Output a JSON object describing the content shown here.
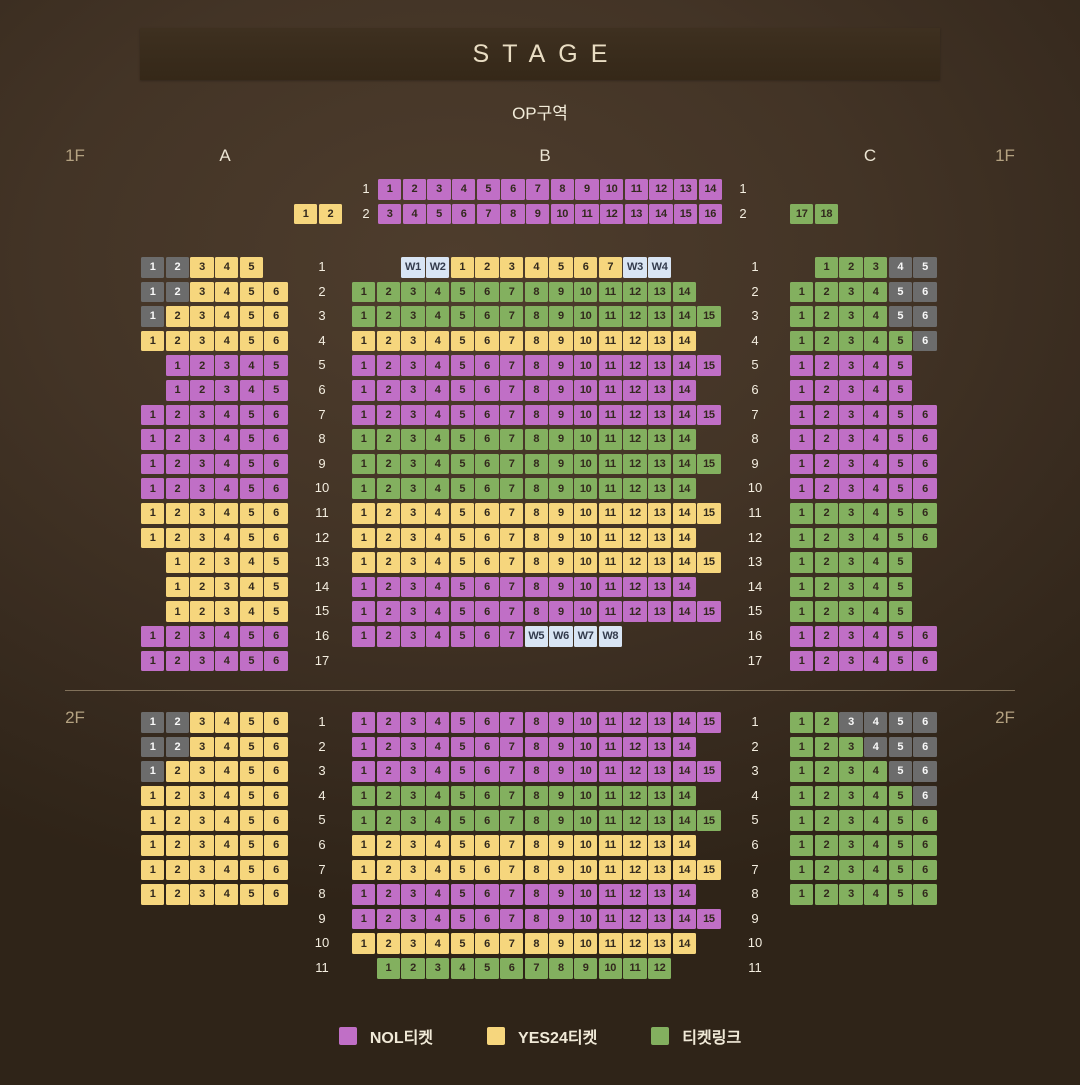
{
  "stage": {
    "label": "STAGE"
  },
  "op_label": "OP구역",
  "section_labels": {
    "a": "A",
    "b": "B",
    "c": "C"
  },
  "colors": {
    "nol": "#c06fc6",
    "yes24": "#f6d67d",
    "ticketlink": "#83b05f",
    "unavailable": "#6c6c6c",
    "wheelchair": "#d9e5f4",
    "seat_text_dark": "#32291d",
    "seat_text_light": "#f8f8f8",
    "wheelchair_text": "#333b4d"
  },
  "legend": [
    {
      "code": "p",
      "label": "NOL티켓"
    },
    {
      "code": "y",
      "label": "YES24티켓"
    },
    {
      "code": "g",
      "label": "티켓링크"
    }
  ],
  "op": {
    "left_row": {
      "label": "2",
      "start": 1,
      "seats": "1:y,2:y"
    },
    "b_rows": [
      {
        "label": "1",
        "start": 1,
        "seats": "1-14:p"
      },
      {
        "label": "2",
        "start": 1,
        "seats": "3-16:p"
      }
    ],
    "right_row": {
      "label": "2",
      "start": 1,
      "seats": "17:g,18:g"
    },
    "left_labels": [
      "1",
      "2"
    ],
    "right_labels": [
      "1",
      "2"
    ]
  },
  "floor1": {
    "name": "1F",
    "row_labels": [
      "1",
      "2",
      "3",
      "4",
      "5",
      "6",
      "7",
      "8",
      "9",
      "10",
      "11",
      "12",
      "13",
      "14",
      "15",
      "16",
      "17"
    ],
    "a_rows": [
      {
        "label": "1",
        "start": 1,
        "seats": "1:x,2:x,3-5:y"
      },
      {
        "label": "2",
        "start": 1,
        "seats": "1:x,2:x,3-6:y"
      },
      {
        "label": "3",
        "start": 1,
        "seats": "1:x,2-6:y"
      },
      {
        "label": "4",
        "start": 1,
        "seats": "1-6:y"
      },
      {
        "label": "5",
        "start": 2,
        "seats": "1-5:p"
      },
      {
        "label": "6",
        "start": 2,
        "seats": "1-5:p"
      },
      {
        "label": "7",
        "start": 1,
        "seats": "1-6:p"
      },
      {
        "label": "8",
        "start": 1,
        "seats": "1-6:p"
      },
      {
        "label": "9",
        "start": 1,
        "seats": "1-6:p"
      },
      {
        "label": "10",
        "start": 1,
        "seats": "1-6:p"
      },
      {
        "label": "11",
        "start": 1,
        "seats": "1-6:y"
      },
      {
        "label": "12",
        "start": 1,
        "seats": "1-6:y"
      },
      {
        "label": "13",
        "start": 2,
        "seats": "1-5:y"
      },
      {
        "label": "14",
        "start": 2,
        "seats": "1-5:y"
      },
      {
        "label": "15",
        "start": 2,
        "seats": "1-5:y"
      },
      {
        "label": "16",
        "start": 1,
        "seats": "1-6:p"
      },
      {
        "label": "17",
        "start": 1,
        "seats": "1-6:p"
      }
    ],
    "b_rows": [
      {
        "label": "1",
        "start": 3,
        "seats": "W1:w,W2:w,1-7:y,W3:w,W4:w"
      },
      {
        "label": "2",
        "start": 1,
        "seats": "1-14:g"
      },
      {
        "label": "3",
        "start": 1,
        "seats": "1-15:g"
      },
      {
        "label": "4",
        "start": 1,
        "seats": "1-14:y"
      },
      {
        "label": "5",
        "start": 1,
        "seats": "1-15:p"
      },
      {
        "label": "6",
        "start": 1,
        "seats": "1-14:p"
      },
      {
        "label": "7",
        "start": 1,
        "seats": "1-15:p"
      },
      {
        "label": "8",
        "start": 1,
        "seats": "1-14:g"
      },
      {
        "label": "9",
        "start": 1,
        "seats": "1-15:g"
      },
      {
        "label": "10",
        "start": 1,
        "seats": "1-14:g"
      },
      {
        "label": "11",
        "start": 1,
        "seats": "1-15:y"
      },
      {
        "label": "12",
        "start": 1,
        "seats": "1-14:y"
      },
      {
        "label": "13",
        "start": 1,
        "seats": "1-15:y"
      },
      {
        "label": "14",
        "start": 1,
        "seats": "1-14:p"
      },
      {
        "label": "15",
        "start": 1,
        "seats": "1-15:p"
      },
      {
        "label": "16",
        "start": 1,
        "seats": "1-7:p,W5:w,W6:w,W7:w,W8:w"
      },
      {
        "label": "17",
        "start": 1,
        "seats": ""
      }
    ],
    "c_rows": [
      {
        "label": "1",
        "start": 2,
        "seats": "1-3:g,4:x,5:x"
      },
      {
        "label": "2",
        "start": 1,
        "seats": "1-4:g,5:x,6:x"
      },
      {
        "label": "3",
        "start": 1,
        "seats": "1-4:g,5:x,6:x"
      },
      {
        "label": "4",
        "start": 1,
        "seats": "1-5:g,6:x"
      },
      {
        "label": "5",
        "start": 1,
        "seats": "1-5:p"
      },
      {
        "label": "6",
        "start": 1,
        "seats": "1-5:p"
      },
      {
        "label": "7",
        "start": 1,
        "seats": "1-6:p"
      },
      {
        "label": "8",
        "start": 1,
        "seats": "1-6:p"
      },
      {
        "label": "9",
        "start": 1,
        "seats": "1-6:p"
      },
      {
        "label": "10",
        "start": 1,
        "seats": "1-6:p"
      },
      {
        "label": "11",
        "start": 1,
        "seats": "1-6:g"
      },
      {
        "label": "12",
        "start": 1,
        "seats": "1-6:g"
      },
      {
        "label": "13",
        "start": 1,
        "seats": "1-5:g"
      },
      {
        "label": "14",
        "start": 1,
        "seats": "1-5:g"
      },
      {
        "label": "15",
        "start": 1,
        "seats": "1-5:g"
      },
      {
        "label": "16",
        "start": 1,
        "seats": "1-6:p"
      },
      {
        "label": "17",
        "start": 1,
        "seats": "1-6:p"
      }
    ]
  },
  "floor2": {
    "name": "2F",
    "row_labels": [
      "1",
      "2",
      "3",
      "4",
      "5",
      "6",
      "7",
      "8",
      "9",
      "10",
      "11"
    ],
    "a_rows": [
      {
        "label": "1",
        "start": 1,
        "seats": "1:x,2:x,3-6:y"
      },
      {
        "label": "2",
        "start": 1,
        "seats": "1:x,2:x,3-6:y"
      },
      {
        "label": "3",
        "start": 1,
        "seats": "1:x,2-6:y"
      },
      {
        "label": "4",
        "start": 1,
        "seats": "1-6:y"
      },
      {
        "label": "5",
        "start": 1,
        "seats": "1-6:y"
      },
      {
        "label": "6",
        "start": 1,
        "seats": "1-6:y"
      },
      {
        "label": "7",
        "start": 1,
        "seats": "1-6:y"
      },
      {
        "label": "8",
        "start": 1,
        "seats": "1-6:y"
      }
    ],
    "b_rows": [
      {
        "label": "1",
        "start": 1,
        "seats": "1-15:p"
      },
      {
        "label": "2",
        "start": 1,
        "seats": "1-14:p"
      },
      {
        "label": "3",
        "start": 1,
        "seats": "1-15:p"
      },
      {
        "label": "4",
        "start": 1,
        "seats": "1-14:g"
      },
      {
        "label": "5",
        "start": 1,
        "seats": "1-15:g"
      },
      {
        "label": "6",
        "start": 1,
        "seats": "1-14:y"
      },
      {
        "label": "7",
        "start": 1,
        "seats": "1-15:y"
      },
      {
        "label": "8",
        "start": 1,
        "seats": "1-14:p"
      },
      {
        "label": "9",
        "start": 1,
        "seats": "1-15:p"
      },
      {
        "label": "10",
        "start": 1,
        "seats": "1-14:y"
      },
      {
        "label": "11",
        "start": 2,
        "seats": "1-12:g"
      }
    ],
    "c_rows": [
      {
        "label": "1",
        "start": 1,
        "seats": "1:g,2:g,3-6:x"
      },
      {
        "label": "2",
        "start": 1,
        "seats": "1-3:g,4-6:x"
      },
      {
        "label": "3",
        "start": 1,
        "seats": "1-4:g,5:x,6:x"
      },
      {
        "label": "4",
        "start": 1,
        "seats": "1-5:g,6:x"
      },
      {
        "label": "5",
        "start": 1,
        "seats": "1-6:g"
      },
      {
        "label": "6",
        "start": 1,
        "seats": "1-6:g"
      },
      {
        "label": "7",
        "start": 1,
        "seats": "1-6:g"
      },
      {
        "label": "8",
        "start": 1,
        "seats": "1-6:g"
      }
    ]
  }
}
